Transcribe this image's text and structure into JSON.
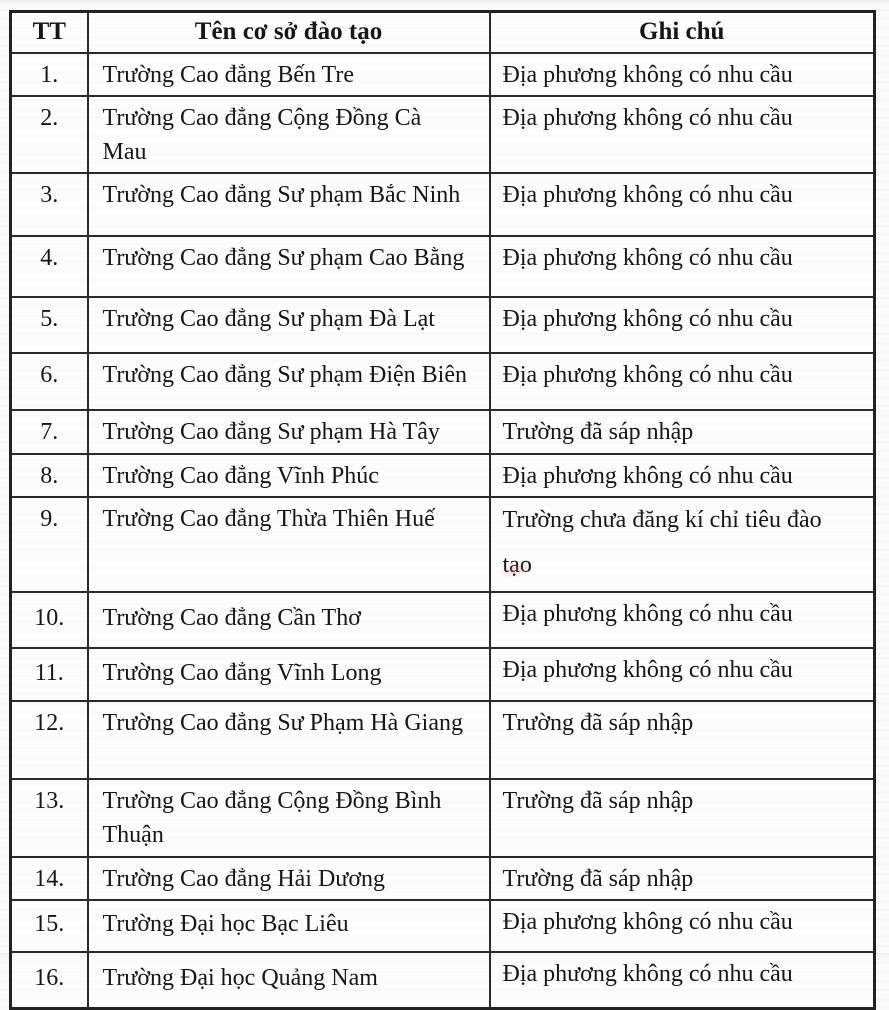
{
  "colors": {
    "paper": "#fbfbfa",
    "border": "#2b2b2b",
    "text": "#161616"
  },
  "table": {
    "headers": {
      "tt": "TT",
      "name": "Tên cơ sở đào tạo",
      "note": "Ghi chú"
    },
    "rows": [
      {
        "tt": "1.",
        "name": "Trường Cao đẳng Bến Tre",
        "note": "Địa phương không có nhu cầu"
      },
      {
        "tt": "2.",
        "name": "Trường Cao đẳng Cộng Đồng Cà Mau",
        "note": "Địa phương không có nhu cầu"
      },
      {
        "tt": "3.",
        "name": "Trường Cao đẳng Sư phạm Bắc Ninh",
        "note": "Địa phương không có nhu cầu"
      },
      {
        "tt": "4.",
        "name": "Trường Cao đẳng Sư phạm Cao Bằng",
        "note": "Địa phương không có nhu cầu"
      },
      {
        "tt": "5.",
        "name": "Trường Cao đẳng Sư phạm Đà Lạt",
        "note": "Địa phương không có nhu cầu"
      },
      {
        "tt": "6.",
        "name": "Trường Cao đẳng Sư phạm Điện Biên",
        "note": "Địa phương không có nhu cầu"
      },
      {
        "tt": "7.",
        "name": "Trường Cao đẳng Sư phạm Hà Tây",
        "note": "Trường đã sáp nhập"
      },
      {
        "tt": "8.",
        "name": "Trường Cao đẳng Vĩnh Phúc",
        "note": "Địa phương không có nhu cầu"
      },
      {
        "tt": "9.",
        "name": "Trường Cao đẳng Thừa Thiên Huế",
        "note": "Trường chưa đăng kí chỉ tiêu đào tạo"
      },
      {
        "tt": "10.",
        "name": "Trường Cao đẳng Cần Thơ",
        "note": "Địa phương không có nhu cầu"
      },
      {
        "tt": "11.",
        "name": "Trường Cao đẳng Vĩnh Long",
        "note": "Địa phương không có nhu cầu"
      },
      {
        "tt": "12.",
        "name": "Trường Cao đẳng Sư Phạm Hà Giang",
        "note": "Trường đã sáp nhập"
      },
      {
        "tt": "13.",
        "name": "Trường Cao đẳng Cộng Đồng Bình Thuận",
        "note": "Trường đã sáp nhập"
      },
      {
        "tt": "14.",
        "name": "Trường Cao đẳng Hải Dương",
        "note": "Trường đã sáp nhập"
      },
      {
        "tt": "15.",
        "name": "Trường Đại học Bạc Liêu",
        "note": "Địa phương không có nhu cầu"
      },
      {
        "tt": "16.",
        "name": "Trường Đại học Quảng Nam",
        "note": "Địa phương không có nhu cầu"
      }
    ]
  }
}
